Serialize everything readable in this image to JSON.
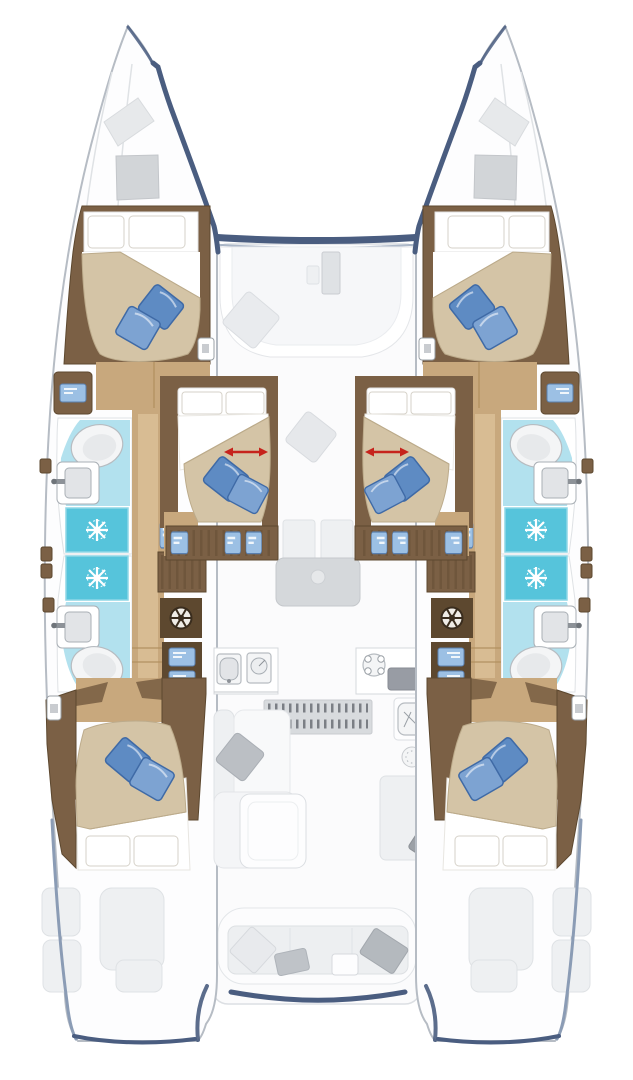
{
  "figure": {
    "type": "yacht-floorplan-diagram",
    "subject": "catamaran interior layout, overhead plan view",
    "orientation": "bows at top, sterns at bottom",
    "symmetry": "port (left) and starboard (right) hulls are mirrored",
    "counts": {
      "double_berths": 6,
      "bathrooms": 4,
      "showers": 4,
      "toilets": 4,
      "washbasins": 4,
      "washing_machines": 2,
      "blue_throw_pillows": 12,
      "sliding_berth_arrows": 2
    },
    "areas": {
      "foredeck": {
        "features": [
          "open bow area",
          "deck hatch on each bow",
          "forward crossbeam edge band",
          "forward cockpit bench with console and scatter cushion"
        ],
        "icons": [
          "hatch-icon",
          "cushion-icon"
        ]
      },
      "port_hull": {
        "forward_cabin": {
          "berth": "double",
          "bedding": [
            "2 white head pillows",
            "beige duvet with folded white sheet",
            "2 blue throw pillows"
          ],
          "icons": [
            "bed-icon",
            "pillow-icon"
          ]
        },
        "forward_bathroom": {
          "fixtures": [
            "toilet",
            "washbasin with faucet",
            "shower with shower-head rose"
          ],
          "icons": [
            "toilet-icon",
            "sink-icon",
            "shower-head-icon"
          ]
        },
        "aft_bathroom": {
          "fixtures": [
            "shower with shower-head rose",
            "washbasin with faucet",
            "toilet"
          ],
          "icons": [
            "shower-head-icon",
            "sink-icon",
            "toilet-icon"
          ]
        },
        "companionway": {
          "fixtures": [
            "wood cabinetry",
            "vanity seat with blue cushion",
            "window panel",
            "washing machine",
            "2 blue locker fronts",
            "hull window tabs"
          ],
          "icons": [
            "washing-machine-icon",
            "locker-icon",
            "window-icon"
          ]
        },
        "aft_cabin": {
          "berth": "double",
          "bedding": [
            "2 white head pillows",
            "beige duvet with folded white sheet",
            "2 blue throw pillows"
          ],
          "icons": [
            "bed-icon",
            "pillow-icon"
          ]
        }
      },
      "starboard_hull": {
        "note": "mirror image of port hull"
      },
      "nacelle_cabins": [
        {
          "id": "port-center",
          "berth": "double sliding berth",
          "marker": "red double-headed slide arrow",
          "storage": "cabinet with 3 blue panel fronts",
          "icons": [
            "slide-arrow-icon",
            "bed-icon"
          ]
        },
        {
          "id": "starboard-center",
          "berth": "double sliding berth",
          "marker": "red double-headed slide arrow",
          "storage": "cabinet with 3 blue panel fronts",
          "icons": [
            "slide-arrow-icon",
            "bed-icon"
          ]
        }
      ],
      "saloon": {
        "features": [
          "dinette table with cup recess",
          "galley sink unit",
          "galley prep unit",
          "4-burner stove",
          "dark worktop",
          "companionway tread strip",
          "L-sofa with chaise and grey pillow",
          "coffee table",
          "nav instrument panel",
          "round speaker dial",
          "nav seat pillow"
        ],
        "icons": [
          "stove-icon",
          "sink-icon",
          "dial-icon",
          "steps-icon"
        ]
      },
      "aft_cockpit": {
        "features": [
          "bench seat with 4 scatter cushions",
          "transom step boxes",
          "stern platforms",
          "aft edge band"
        ],
        "icons": [
          "cushion-icon"
        ]
      }
    }
  },
  "palette": {
    "hull_outline": "#b6bcc4",
    "accent_blue": "#4a5d80",
    "accent_soft": "#8b9cb5",
    "ghost_light": "#eef0f2",
    "ghost_mid": "#dfe2e5",
    "ghost_dark": "#c9ccd1",
    "wood_brown": "#7b6045",
    "wood_dark": "#5d482f",
    "floor_tan": "#c8a87d",
    "floor_tan_light": "#dabf97",
    "floor_line": "#b1905f",
    "bed_beige": "#d4c4a6",
    "bed_shadow": "#bcab8b",
    "linen_white": "#ffffff",
    "linen_line": "#d6d2c9",
    "pillow_blue": "#5e8bc3",
    "pillow_blue_light": "#7da3d2",
    "pillow_blue_dark": "#3f6aa6",
    "bath_cyan": "#b2e1ee",
    "shower_cyan": "#56c4db",
    "shower_edge": "#8fd7e6",
    "window_blue": "#9cc0e4",
    "window_blue_dark": "#5a7fae",
    "arrow_red": "#c6231c"
  }
}
